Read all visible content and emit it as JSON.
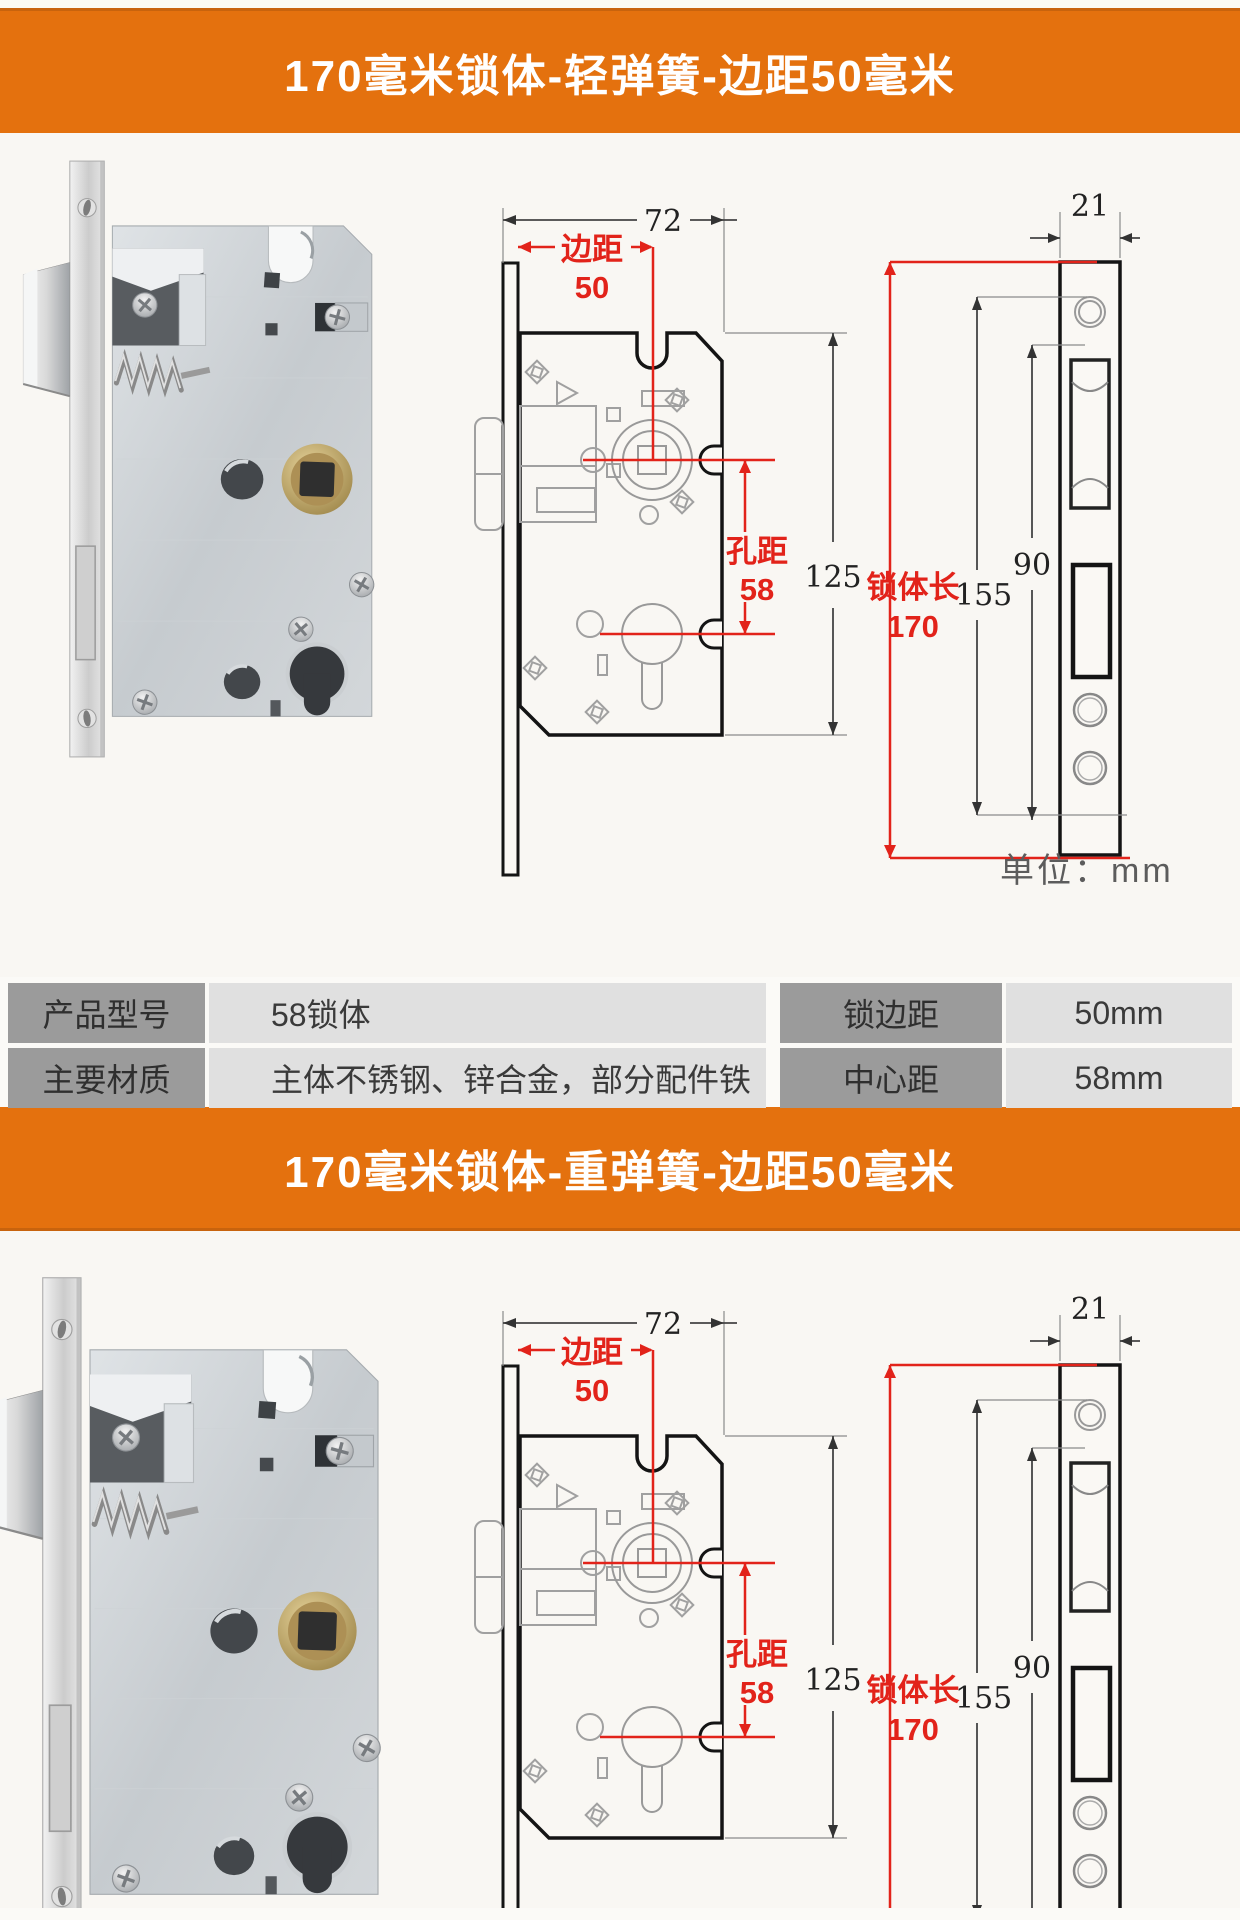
{
  "sections": [
    {
      "title": "170毫米锁体-轻弹簧-边距50毫米"
    },
    {
      "title": "170毫米锁体-重弹簧-边距50毫米"
    }
  ],
  "diagram": {
    "front": {
      "total_width": "72",
      "edge_label": "边距",
      "edge_value": "50",
      "hole_label": "孔距",
      "hole_value": "58",
      "body_height": "125"
    },
    "side": {
      "plate_width": "21",
      "body_length_label": "锁体长",
      "body_length_value": "170",
      "plate_length": "155",
      "hole_span": "90"
    },
    "unit_note": "单位：mm"
  },
  "spec_table": {
    "rows": [
      {
        "c0": "产品型号",
        "c1": "58锁体",
        "c2": "锁边距",
        "c3": "50mm"
      },
      {
        "c0": "主要材质",
        "c1": "主体不锈钢、锌合金，部分配件铁",
        "c2": "中心距",
        "c3": "58mm"
      }
    ]
  },
  "colors": {
    "banner_orange": "#e4710e",
    "dimension_red": "#e2231a",
    "table_label_bg": "#9b9b9b",
    "table_value_bg": "#e0e0e0"
  }
}
